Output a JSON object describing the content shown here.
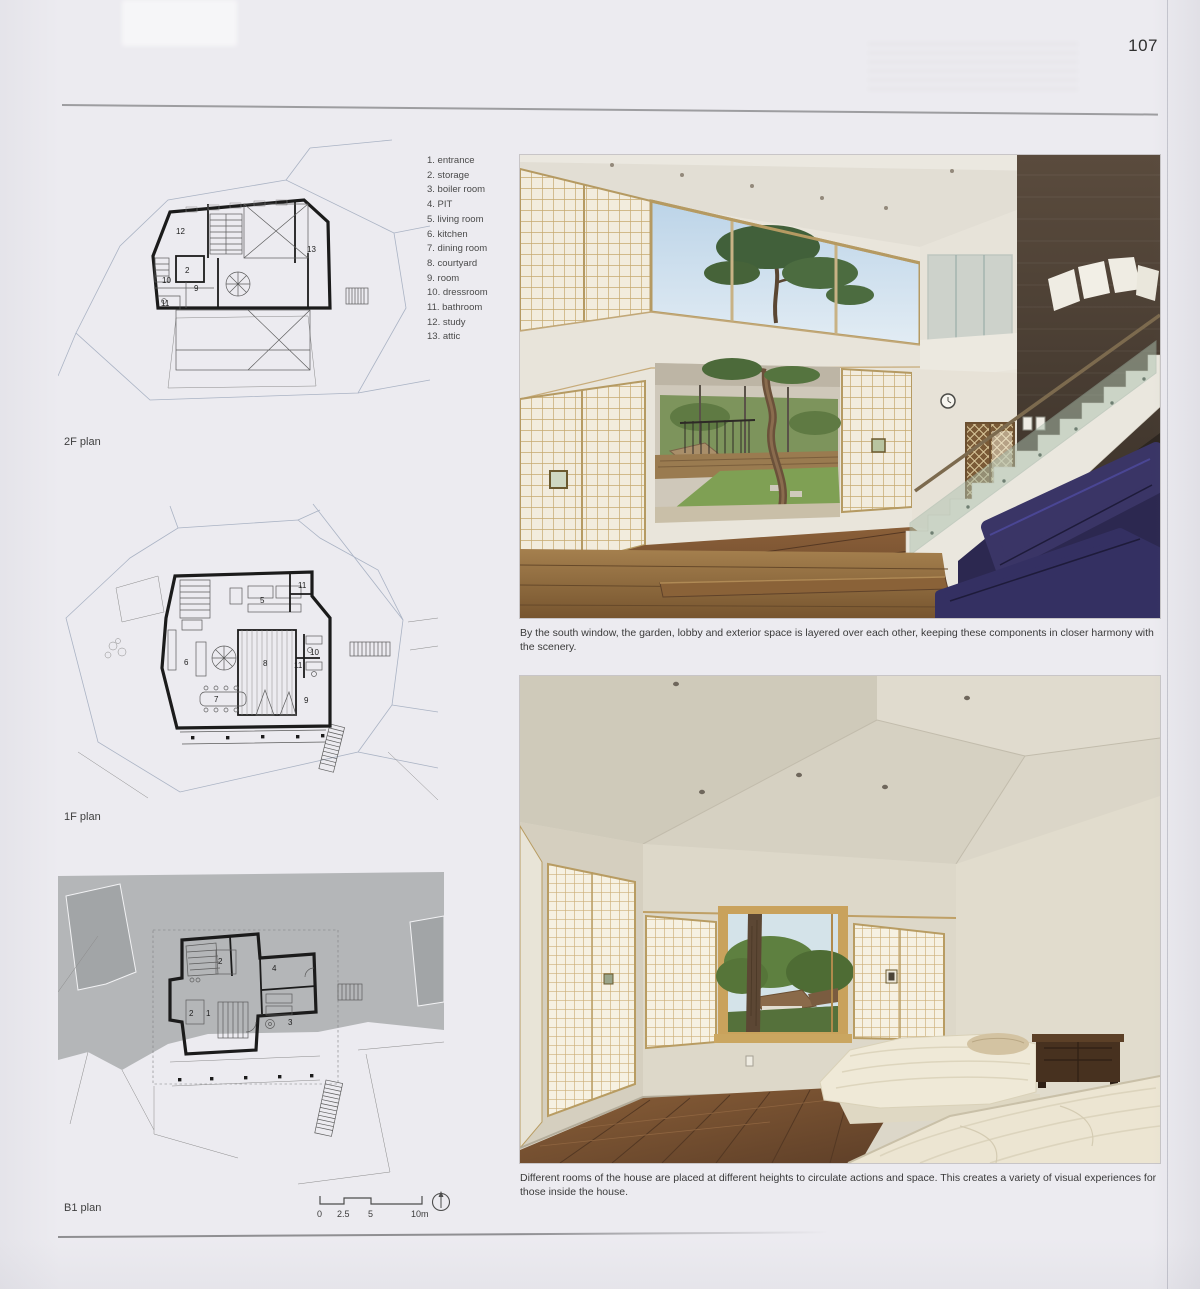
{
  "page": {
    "number": "107"
  },
  "legend": {
    "items": [
      "1. entrance",
      "2. storage",
      "3. boiler room",
      "4. PIT",
      "5. living room",
      "6. kitchen",
      "7. dining room",
      "8. courtyard",
      "9. room",
      "10. dressroom",
      "11. bathroom",
      "12. study",
      "13. attic"
    ]
  },
  "plans": {
    "f2": {
      "label": "2F plan",
      "rooms": [
        "12",
        "2",
        "10",
        "9",
        "11",
        "13"
      ]
    },
    "f1": {
      "label": "1F plan",
      "rooms": [
        "5",
        "11",
        "6",
        "8",
        "10",
        "11",
        "7",
        "9"
      ]
    },
    "b1": {
      "label": "B1 plan",
      "rooms": [
        "2",
        "4",
        "2",
        "1",
        "3"
      ]
    }
  },
  "scale_bar": {
    "labels": [
      "0",
      "2.5",
      "5",
      "10m"
    ],
    "north_icon": "north-arrow"
  },
  "photos": {
    "living_room": {
      "caption": "By the south window, the garden, lobby and exterior space is layered over each other, keeping these components in closer harmony with the scenery."
    },
    "bedroom": {
      "caption": "Different rooms of the house are placed at different heights to circulate actions and space. This creates a variety of visual experiences for those inside the house."
    }
  },
  "colors": {
    "page_bg": "#ecebf0",
    "rule": "#8f8f92",
    "text": "#3a3a3a",
    "wall": "#1b1b1b",
    "site": "#aab3c4",
    "site_gray": "#b4b6b8",
    "shoji": "#f2ecdd",
    "shoji_grid": "#c6a96f",
    "dark_wall": "#4a3d32",
    "wood": "#7c5633",
    "sofa": "#2c2850",
    "lawn": "#7fa054",
    "sky": "#c7dbeb"
  }
}
